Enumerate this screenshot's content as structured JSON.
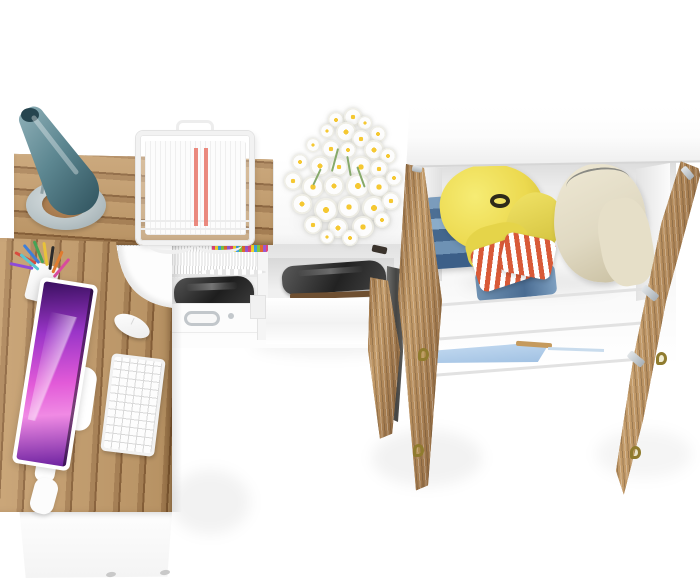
{
  "scene": {
    "type": "3d-furniture-render",
    "view": "top-down bird's-eye view, white studio background",
    "description": "Home office / youth room furniture set seen from directly above: an L-shaped oak corner desk with an all-in-one computer, keyboard, mouse, teal desk lamp, wire document tray and pencil cup; under-desk shelf with notebooks, a dark printer and a drawer with chrome handle; a white storage cabinet topped with a white daisy bouquet; and a tall white wardrobe with both oak doors open showing clothes inside.",
    "colors": {
      "floor-white": "#ffffff",
      "wood-light": "#c49c6a",
      "wood-mid": "#ab8254",
      "wood-dark": "#8a6138",
      "wood-edge": "#7a5634",
      "lamp-teal-1": "#7fa2aa",
      "lamp-teal-2": "#2f525d",
      "lamp-base": "#b9c4c7",
      "screen-1": "#3a1060",
      "screen-2": "#9a35c8",
      "screen-3": "#e25ad8",
      "screen-4": "#f08ae4",
      "jacket-yellow": "#ecd94f",
      "jacket-yellow-2": "#cdbb35",
      "coat-beige": "#e0d9c2",
      "coat-beige-2": "#c7bd9e",
      "jeans-1": "#7b9cbc",
      "jeans-2": "#4d6f94",
      "stripe-red": "#d85a38",
      "blue-shelf": "#9fc0e2",
      "blue-shelf-2": "#c6dcf2",
      "brass": "#8f7b2e",
      "chrome": "#c2c7cb",
      "paper-red": "#e87568"
    },
    "objects": {
      "desk": {
        "shape": "L-shaped corner desk",
        "top_material": "oak wood",
        "base_material": "white laminate",
        "items_on_top": [
          "desk-lamp",
          "document-tray",
          "pencil-cup",
          "monitor",
          "keyboard",
          "mouse"
        ]
      },
      "desk_lamp": {
        "shade": "teal cone",
        "base": "grey oval ring"
      },
      "document_tray": {
        "material": "white wire",
        "contents": "white papers with two red printed stripes"
      },
      "pencil_cup": {
        "pen_colors": [
          "#d94b3f",
          "#3f7fd9",
          "#46a356",
          "#e8c23a",
          "#2b2b2b",
          "#e07b2e",
          "#8e4bd9",
          "#d94b9d",
          "#5bc6d0"
        ]
      },
      "computer": {
        "style": "white all-in-one monitor with purple galaxy wallpaper",
        "accessories": [
          "white keyboard",
          "white mouse"
        ]
      },
      "under_desk_shelf": {
        "contents": [
          "row of white notebooks with multicolor index tabs",
          "dark grey printer",
          "drawer with chrome handle"
        ]
      },
      "storage_cabinet": {
        "material": "white",
        "on_top": "bouquet of white daisies with yellow centers",
        "inside": "dark grey box on open shelf, wood trim strip"
      },
      "wardrobe": {
        "material": "white carcass, oak doors",
        "state": "both doors open outward",
        "door_hardware": [
          "brass pulls",
          "silver hinges"
        ],
        "contents": [
          "stack of folded jeans",
          "yellow belted jacket on hanger",
          "red-and-white striped folded shirt",
          "folded jeans pile",
          "beige coat on wire hanger",
          "light-blue accent shelf strip in lower compartment"
        ]
      }
    }
  }
}
